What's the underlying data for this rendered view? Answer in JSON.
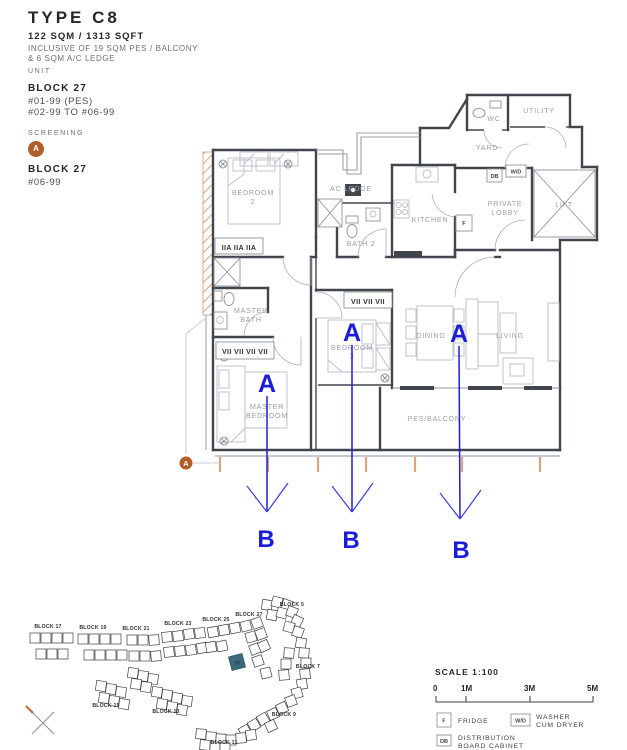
{
  "header": {
    "type_title": "TYPE C8",
    "area": "122 SQM / 1313 SQFT",
    "inclusive_line1": "INCLUSIVE OF 19 SQM PES / BALCONY",
    "inclusive_line2": "& 6 SQM A/C LEDGE",
    "unit_label": "UNIT",
    "unit_block": "BLOCK 27",
    "unit_line1": "#01-99 (PES)",
    "unit_line2": "#02-99 TO #06-99",
    "screening_label": "SCREENING",
    "screening_marker": "A",
    "screening_block": "BLOCK 27",
    "screening_unit": "#06-99"
  },
  "plan": {
    "rooms": [
      {
        "lines": [
          "BEDROOM",
          "2"
        ]
      },
      {
        "lines": [
          "AC LEDGE"
        ]
      },
      {
        "lines": [
          "BATH 2"
        ]
      },
      {
        "lines": [
          "KITCHEN"
        ]
      },
      {
        "lines": [
          "YARD"
        ]
      },
      {
        "lines": [
          "WC"
        ]
      },
      {
        "lines": [
          "UTILITY"
        ]
      },
      {
        "lines": [
          "PRIVATE",
          "LOBBY"
        ]
      },
      {
        "lines": [
          "LIFT"
        ]
      },
      {
        "lines": [
          "MASTER",
          "BATH"
        ]
      },
      {
        "lines": [
          "MASTER",
          "BEDROOM"
        ]
      },
      {
        "lines": [
          "BEDROOM",
          "3"
        ]
      },
      {
        "lines": [
          "DINING"
        ]
      },
      {
        "lines": [
          "LIVING"
        ]
      },
      {
        "lines": [
          "PES/BALCONY"
        ]
      }
    ],
    "fixtures": {
      "db": "DB",
      "wd": "W/D",
      "fridge": "F"
    },
    "wardrobes": {
      "bedroom2": "IIA IIA IIA",
      "master": "VII VII VII VII",
      "bedroom3": "VII VII VII"
    },
    "annotations": {
      "a_label": "A",
      "b_label": "B",
      "screening_marker": "A"
    },
    "colors": {
      "annotation_blue": "#1c1cdb",
      "screening_orange": "#b35d2a",
      "wall_dark": "#41464d",
      "hatch_tan": "#dba277",
      "highlight_teal": "#3a6b7d"
    }
  },
  "site_plan": {
    "blocks": [
      "BLOCK 17",
      "BLOCK 19",
      "BLOCK 21",
      "BLOCK 23",
      "BLOCK 25",
      "BLOCK 27",
      "BLOCK 5",
      "BLOCK 7",
      "BLOCK 9",
      "BLOCK 11",
      "BLOCK 13",
      "BLOCK 15"
    ],
    "highlighted_unit": "99"
  },
  "scale_bar": {
    "label": "SCALE 1:100",
    "ticks": [
      "0",
      "1M",
      "3M",
      "5M"
    ]
  },
  "legend": [
    {
      "symbol": "F",
      "line1": "FRIDGE",
      "line2": ""
    },
    {
      "symbol": "W/D",
      "line1": "WASHER",
      "line2": "CUM DRYER"
    },
    {
      "symbol": "DB",
      "line1": "DISTRIBUTION",
      "line2": "BOARD CABINET"
    }
  ]
}
